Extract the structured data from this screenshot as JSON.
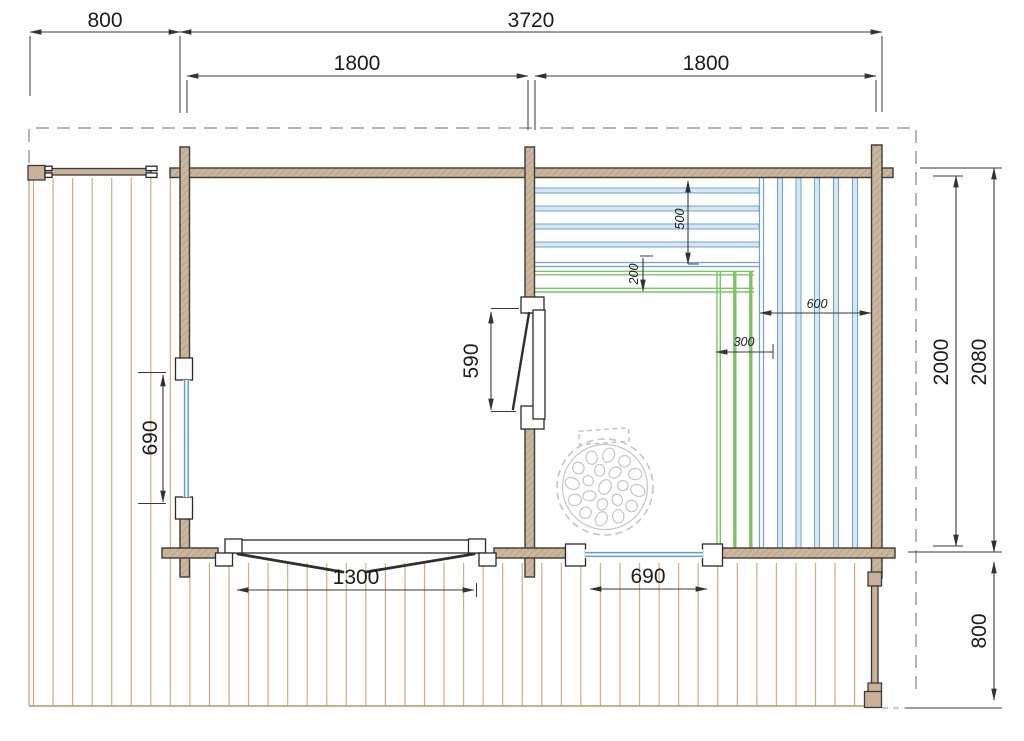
{
  "drawing": {
    "type": "floor-plan",
    "dims": {
      "deck_left_width": "800",
      "total_width": "3720",
      "room_left_width": "1800",
      "room_right_width": "1800",
      "side_window_width": "690",
      "sauna_door_width": "590",
      "bench_top_depth": "500",
      "bench_step_depth": "200",
      "bench_side_width": "600",
      "bench_step_width": "300",
      "entry_door_width": "1300",
      "front_window_width": "690",
      "inner_depth": "2000",
      "total_depth": "2080",
      "front_deck_depth": "800"
    },
    "palette": {
      "wall_fill": "#ccb79c",
      "wall_hatch": "#bba386",
      "outline": "#3a3a3a",
      "deck_plank": "#d2ad80",
      "bench_blue_fill": "#d6e8f6",
      "bench_blue_edge": "#6fa3cf",
      "bench_green": "#7cc464",
      "glass_blue": "#5f9fd6",
      "boundary_gray": "#b5b5b5",
      "stove_gray": "#c6c6c6"
    }
  }
}
